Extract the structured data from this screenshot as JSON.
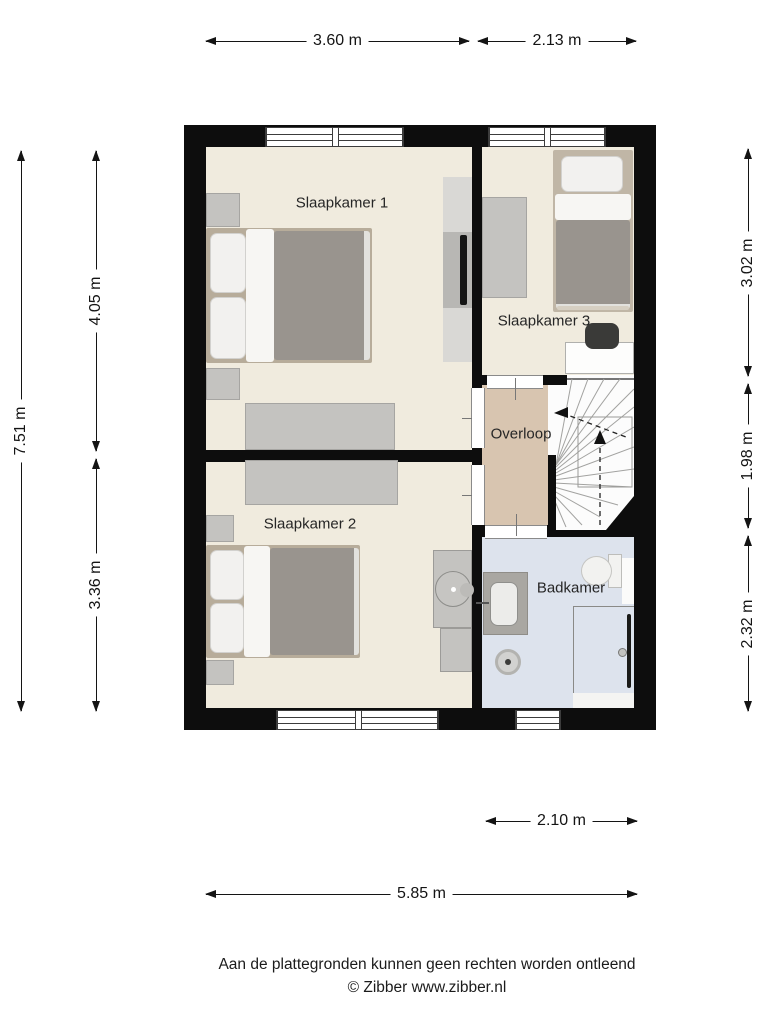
{
  "rooms": {
    "slaapkamer1": "Slaapkamer 1",
    "slaapkamer2": "Slaapkamer 2",
    "slaapkamer3": "Slaapkamer 3",
    "overloop": "Overloop",
    "badkamer": "Badkamer"
  },
  "dimensions": {
    "top": [
      "3.60 m",
      "2.13 m"
    ],
    "left_total": "7.51 m",
    "left": [
      "4.05 m",
      "3.36 m"
    ],
    "right": [
      "3.02 m",
      "1.98 m",
      "2.32 m"
    ],
    "bottom_small": "2.10 m",
    "bottom_total": "5.85 m"
  },
  "footer": {
    "disclaimer": "Aan de plattegronden kunnen geen rechten worden ontleend",
    "copyright": "© Zibber www.zibber.nl"
  },
  "colors": {
    "wall": "#0d0d0d",
    "bedroom_floor": "#f0ebde",
    "landing_floor": "#d8c5b0",
    "bathroom_floor": "#dde3ed",
    "furniture_gray": "#c4c3c0",
    "duvet_gray": "#99948e"
  }
}
